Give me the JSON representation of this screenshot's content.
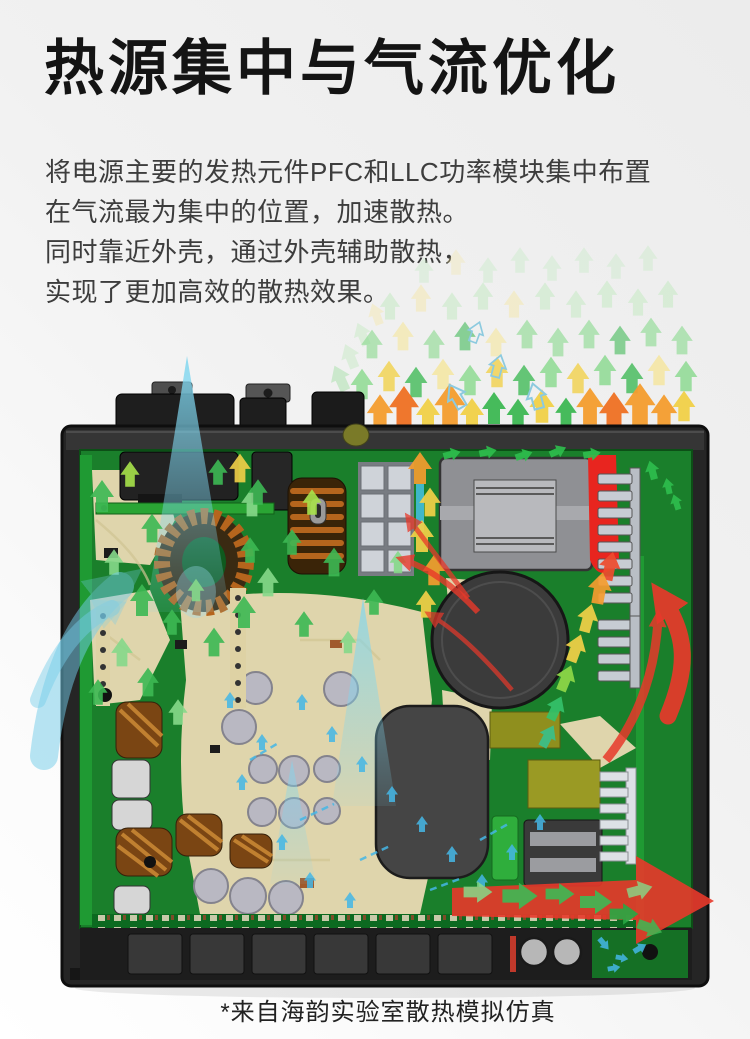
{
  "header": {
    "title": "热源集中与气流优化"
  },
  "intro": {
    "lines": [
      "将电源主要的发热元件PFC和LLC功率模块集中布置",
      "在气流最为集中的位置，加速散热。",
      "同时靠近外壳，通过外壳辅助散热，",
      "实现了更加高效的散热效果。"
    ]
  },
  "figure": {
    "caption": "*来自海韵实验室散热模拟仿真"
  },
  "colors": {
    "pcb_green": "#1a7f2b",
    "case_dark": "#252525",
    "intake_cyan": "#74cdea",
    "cool_arrow_cyan": "#45b7e6",
    "airflow_green": "#3db954",
    "warm_yellow": "#f2d148",
    "hot_orange": "#f59d2f",
    "exhaust_red": "#e8392a"
  }
}
